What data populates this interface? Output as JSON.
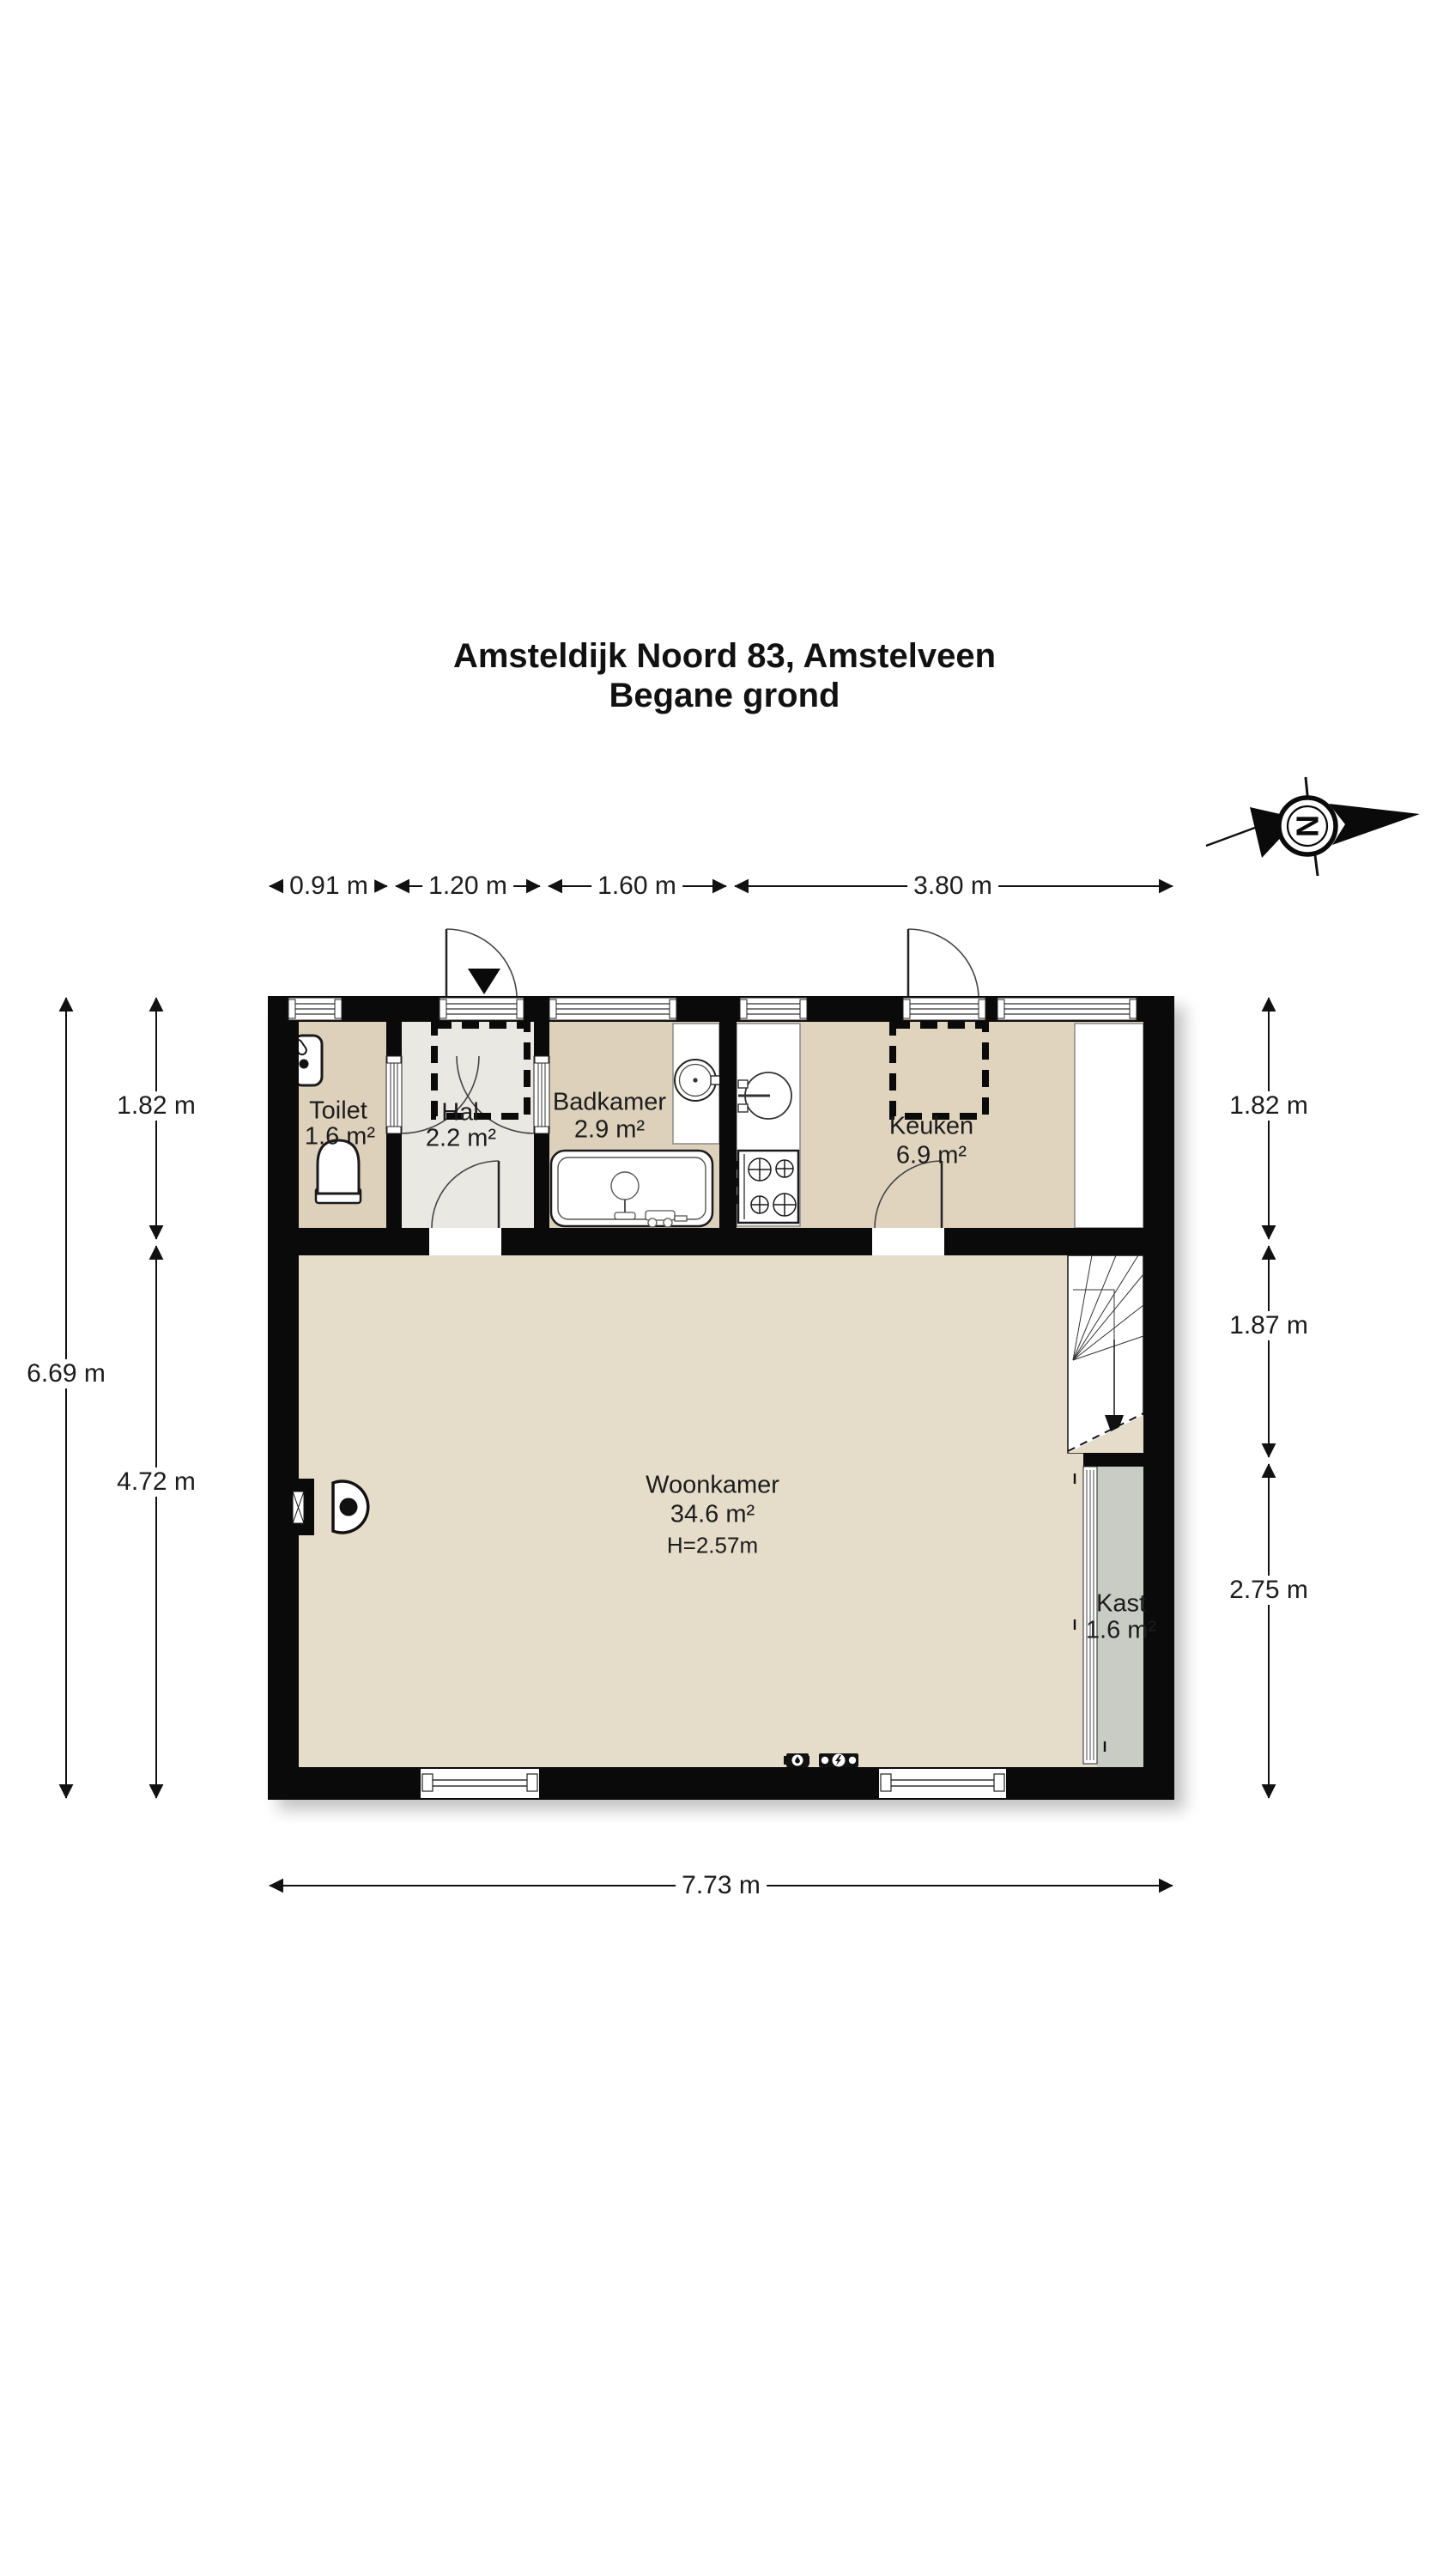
{
  "title": {
    "line1": "Amsteldijk Noord 83, Amstelveen",
    "line2": "Begane grond"
  },
  "compass": {
    "letter": "N"
  },
  "dimensions": {
    "top": [
      "0.91 m",
      "1.20 m",
      "1.60 m",
      "3.80 m"
    ],
    "left_outer": "6.69 m",
    "left_inner": [
      "1.82 m",
      "4.72 m"
    ],
    "right": [
      "1.82 m",
      "1.87 m",
      "2.75 m"
    ],
    "bottom": "7.73 m"
  },
  "rooms": {
    "toilet": {
      "name": "Toilet",
      "area": "1.6 m²"
    },
    "hal": {
      "name": "Hal",
      "area": "2.2 m²"
    },
    "badkamer": {
      "name": "Badkamer",
      "area": "2.9 m²"
    },
    "keuken": {
      "name": "Keuken",
      "area": "6.9 m²"
    },
    "woonkamer": {
      "name": "Woonkamer",
      "area": "34.6 m²",
      "ceiling_height": "H=2.57m"
    },
    "kast": {
      "name": "Kast",
      "area": "1.6 m²"
    }
  },
  "icons": {
    "compass-north-arrow": "rotated N in double circle with black arrow",
    "entrance-arrow": "solid black triangle pointing into front door",
    "stairs-down-arrow": "solid triangle at end of stair walk line",
    "water-meter": "black box with round dial",
    "electricity-meter": "black box with lightning dial"
  },
  "colors": {
    "wall": "#0a0a0a",
    "floor_wet_rooms": "#ddd1bc",
    "floor_kitchen": "#e0d4bf",
    "floor_living": "#e5dcca",
    "floor_hall": "#e9e8e3",
    "floor_closet": "#c8ccc4",
    "fixture_stroke": "#1a1a1a"
  }
}
